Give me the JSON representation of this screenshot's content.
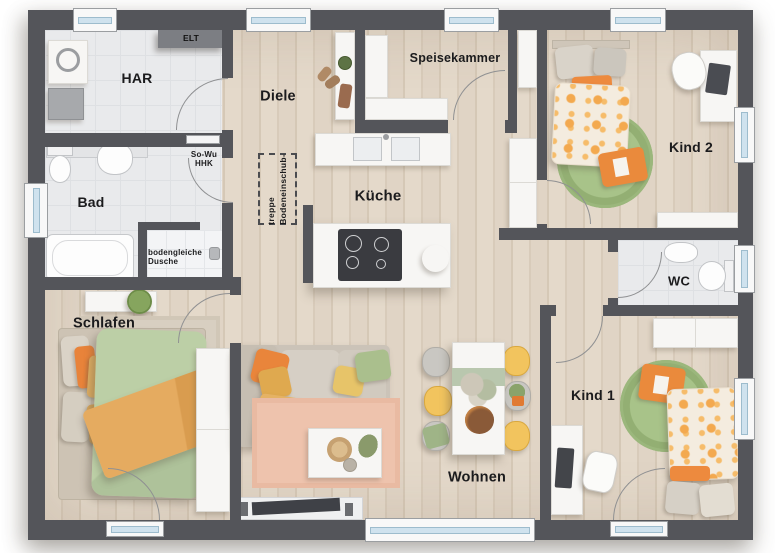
{
  "plan_type": "floor-plan",
  "rooms": {
    "har": {
      "label": "HAR"
    },
    "diele": {
      "label": "Diele"
    },
    "speisekammer": {
      "label": "Speisekammer"
    },
    "kind2": {
      "label": "Kind 2"
    },
    "bad": {
      "label": "Bad"
    },
    "kueche": {
      "label": "Küche"
    },
    "wc": {
      "label": "WC"
    },
    "schlafen": {
      "label": "Schlafen"
    },
    "wohnen": {
      "label": "Wohnen"
    },
    "kind1": {
      "label": "Kind 1"
    }
  },
  "annotations": {
    "elt": {
      "label": "ELT"
    },
    "sowu_hhk": {
      "label": "So-Wu\nHHK"
    },
    "bodengleiche_dusche": {
      "label": "bodengleiche\nDusche"
    },
    "bodeneinschubtreppe": {
      "label": "Bodeneinschub-\ntreppe"
    }
  },
  "colors": {
    "wall": "#54555A",
    "wood_floor": "#E1D5C6",
    "tile_floor": "#E9EAEC",
    "accent_orange": "#EA8A3C",
    "accent_green": "#9DBB7E",
    "accent_yellow": "#F2C45E",
    "accent_sage": "#B9C7AE",
    "rug_pink": "#EEC3AD",
    "window_glass": "#CFE2EE",
    "furniture_white": "#F7F6F4"
  }
}
